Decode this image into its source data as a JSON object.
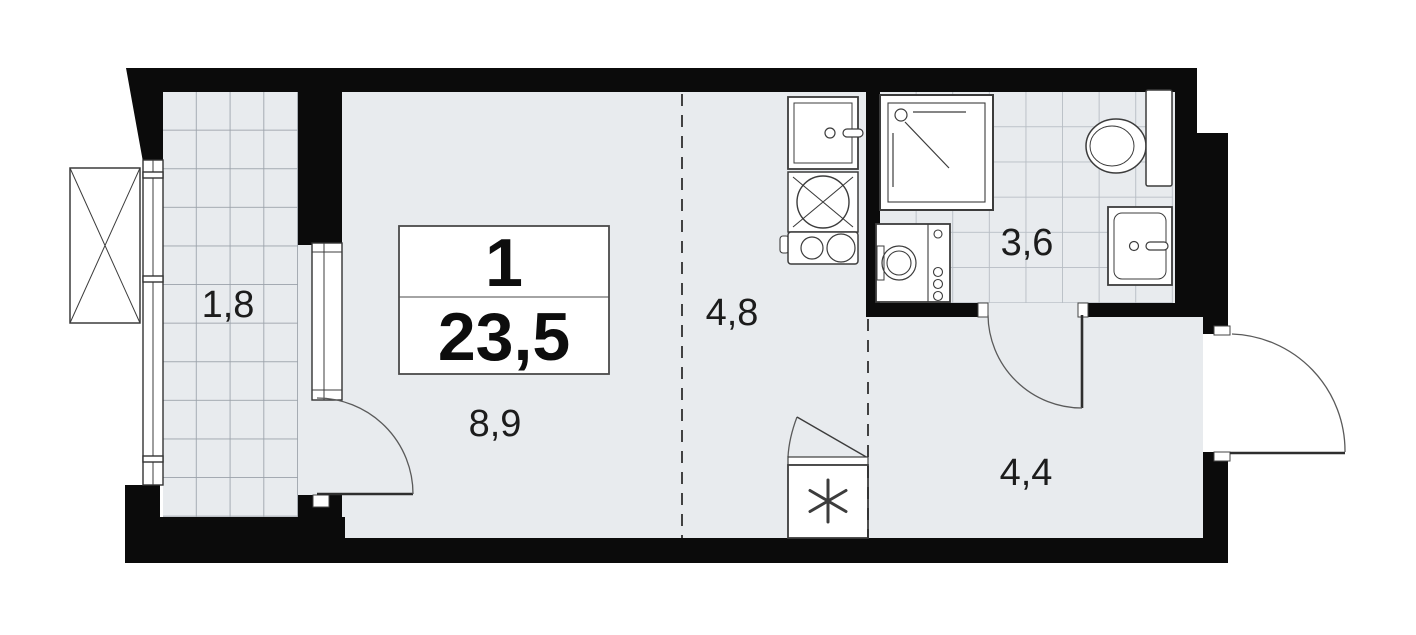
{
  "plan": {
    "title": "studio-apartment-floor-plan",
    "unit_label": {
      "rooms": "1",
      "area": "23,5"
    },
    "areas": {
      "balcony": "1,8",
      "living": "8,9",
      "kitchen": "4,8",
      "bathroom": "3,6",
      "hallway": "4,4"
    },
    "fixtures": [
      "ac-unit",
      "kitchen-sink",
      "kitchen-hob",
      "kitchen-stove",
      "shower-cabin",
      "washing-machine",
      "toilet",
      "bathroom-sink",
      "refrigerator"
    ],
    "colors": {
      "wall": "#0b0b0b",
      "floor": "#e8ebee",
      "balcony_grid": "#9aa1a9",
      "tile_grid": "#b7bdc4",
      "fixture_stroke": "#3c3c3c",
      "accent_text": "#1c1c1c"
    }
  }
}
